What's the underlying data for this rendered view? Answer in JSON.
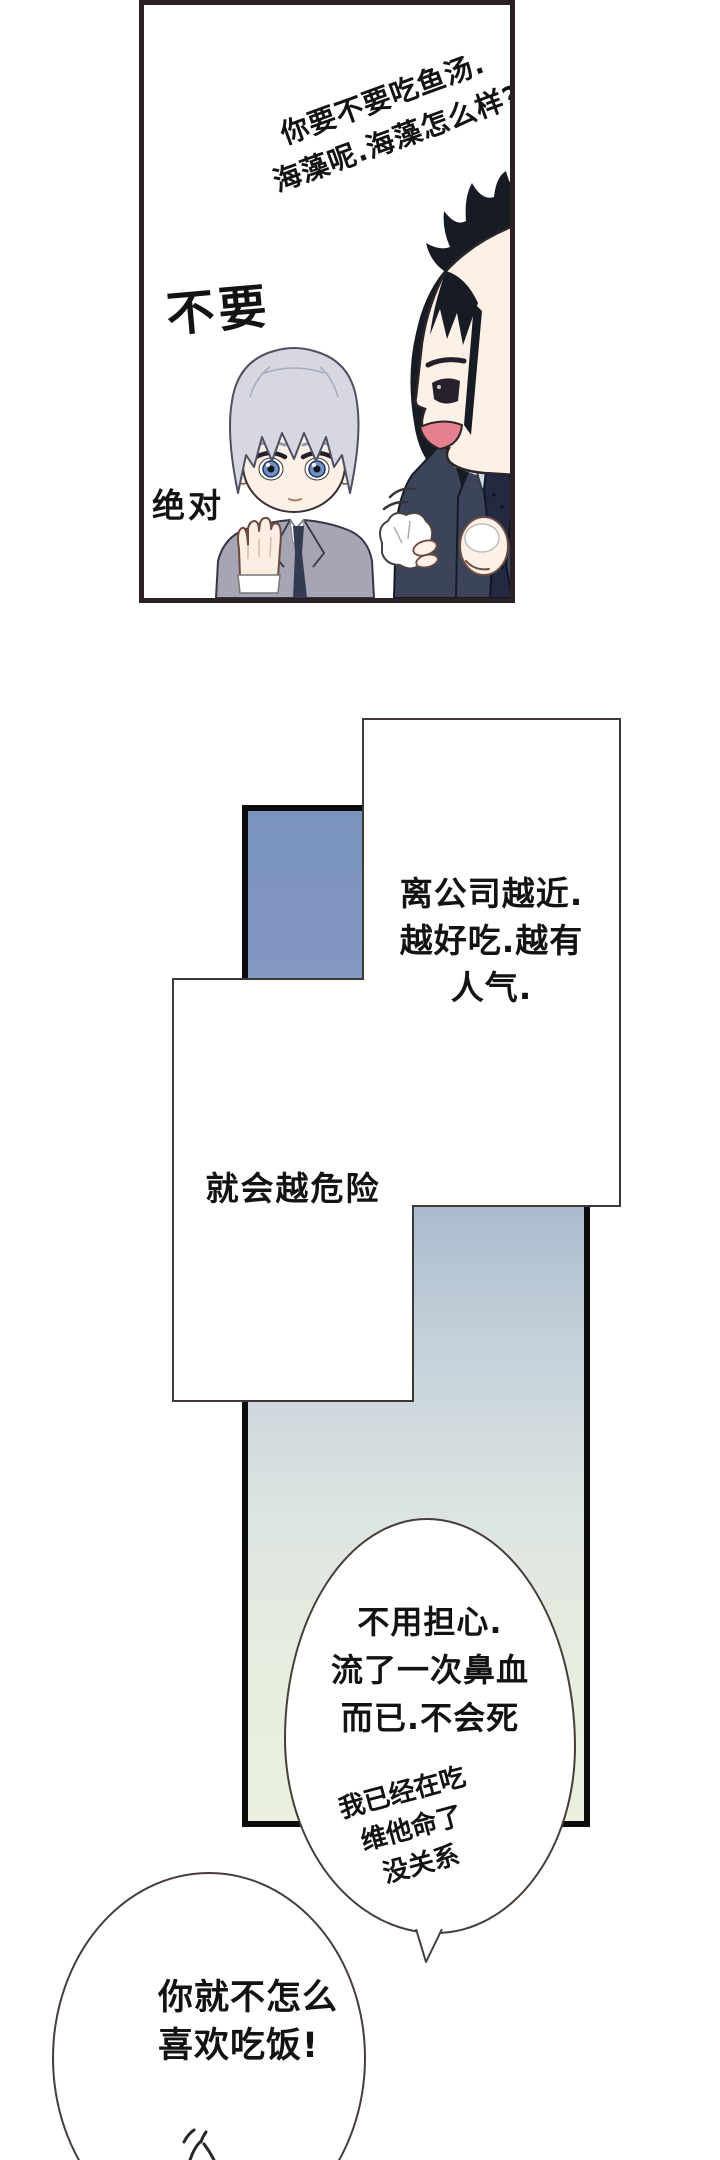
{
  "panel1": {
    "speech_line1": "你要不要吃鱼汤.",
    "speech_line2": "海藻呢.海藻怎么样?",
    "reply_large": "不要",
    "reply_emphasis": "绝对"
  },
  "panel2": {
    "bubble_near_company": {
      "line1": "离公司越近.",
      "line2": "越好吃.越有",
      "line3": "人气."
    },
    "box_danger": "就会越危险",
    "bubble_dont_worry": {
      "line1": "不用担心.",
      "line2": "流了一次鼻血",
      "line3": "而已.不会死"
    },
    "bubble_vitamins": {
      "line1": "我已经在吃",
      "line2": "维他命了",
      "line3": "没关系"
    },
    "bubble_eat": {
      "line1": "你就不怎么",
      "line2": "喜欢吃饭!"
    }
  },
  "colors": {
    "ink": "#151515",
    "panel_frame": "#2a2222",
    "thick_border": "#0c0c0c",
    "thin_border": "#3f3835",
    "gradient_top": "#7b93bf",
    "gradient_bottom": "#ebf1de",
    "silver_hair": "#d7d7e2",
    "gray_suit": "#a7a4b4",
    "navy_suit": "#3c4459",
    "skin": "#fdf0e7",
    "iris_blue": "#6e90c6",
    "mouth_pink": "#e5808f",
    "collar_blue": "#c9dfe3"
  }
}
